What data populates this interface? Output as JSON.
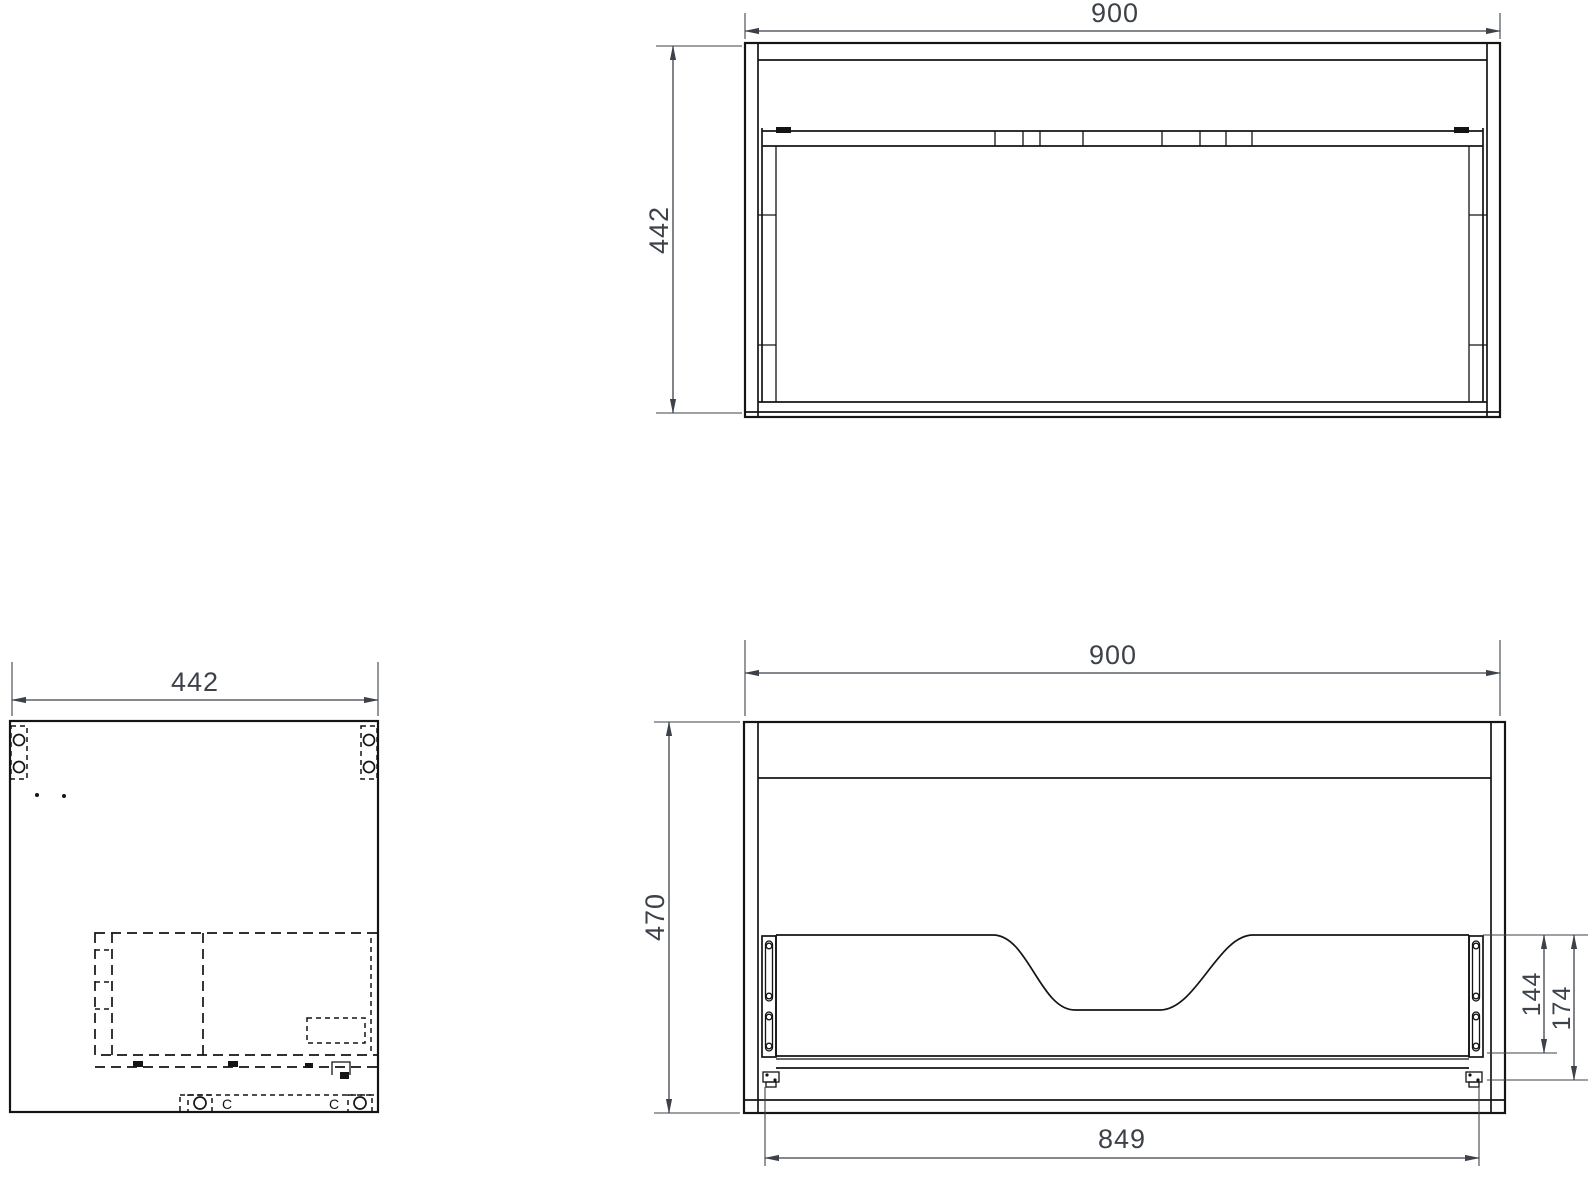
{
  "drawing_title": "vanity-cabinet-orthographic-views",
  "colors": {
    "line": "#141414",
    "dimension": "#3d424a"
  },
  "top_view": {
    "width_dim": "900",
    "depth_dim": "442"
  },
  "side_view": {
    "depth_dim": "442",
    "cam_left_label": "C",
    "cam_right_label": "C"
  },
  "front_view": {
    "width_dim": "900",
    "height_dim": "470",
    "runner_width_dim": "849",
    "drawer_back_dim": "144",
    "drawer_overall_dim": "174"
  }
}
